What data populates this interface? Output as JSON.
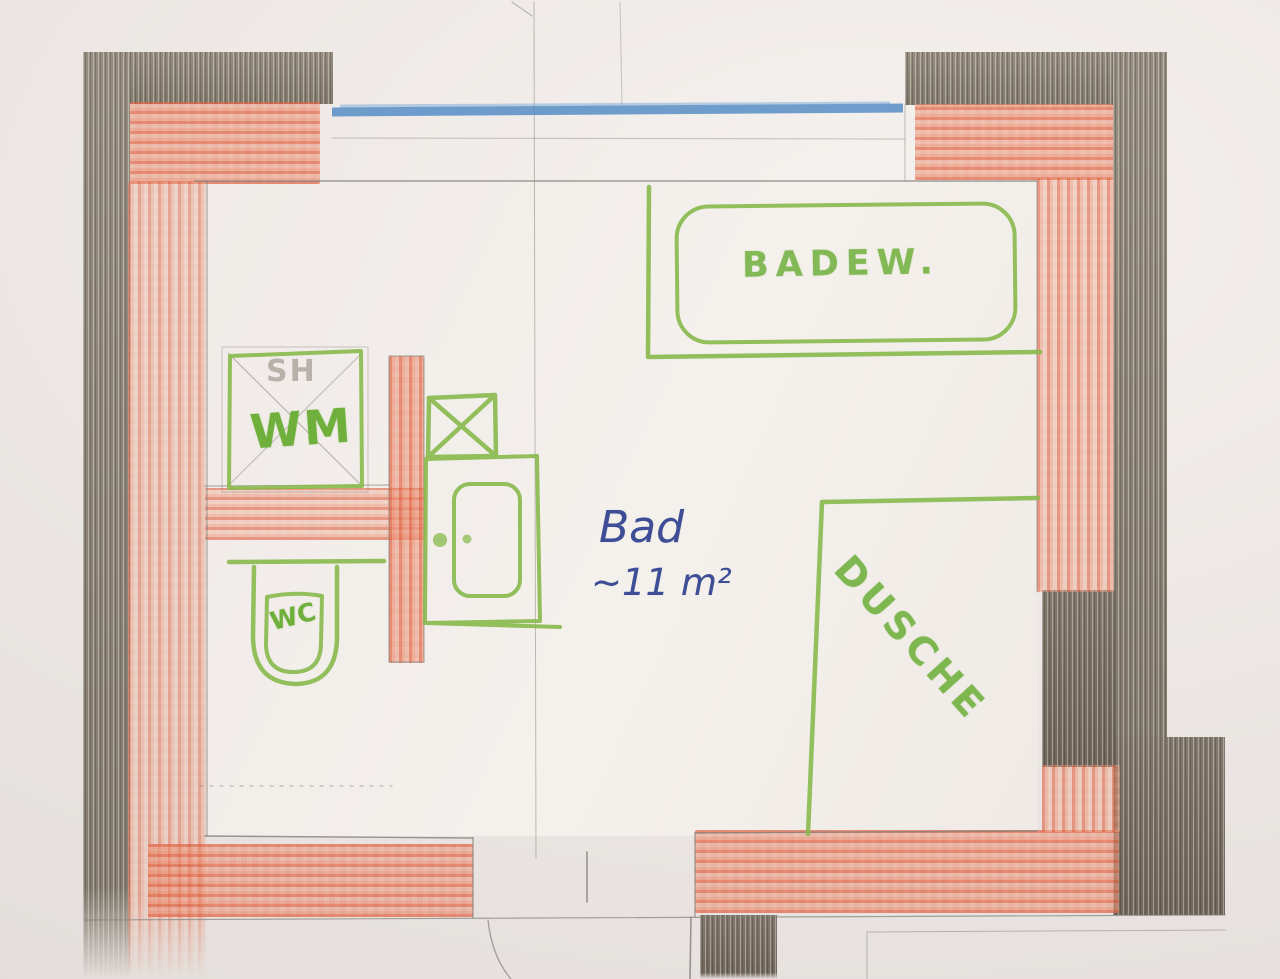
{
  "plan": {
    "room": {
      "name": "Bad",
      "area": "~11 m²"
    },
    "fixtures": {
      "bathtub": "BADEW.",
      "washing_machine": "WM",
      "shaft": "SH",
      "toilet": "WC",
      "shower": "DUSCHE"
    },
    "colors": {
      "paper": "#ece7e4",
      "printed_wall_gray": "#8f8779",
      "marked_wall_red": "#e07a5f",
      "fixture_green": "#88b94c",
      "window_blue": "#4c87c3",
      "handwriting_blue": "#3e4e96"
    }
  }
}
